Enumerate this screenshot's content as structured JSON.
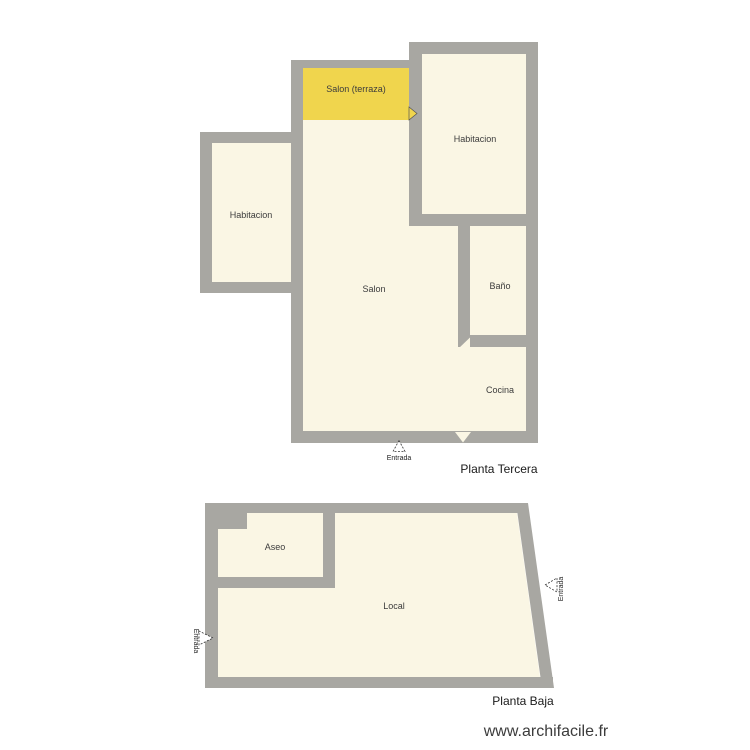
{
  "colors": {
    "wall": "#a8a7a2",
    "room_fill": "#faf6e4",
    "terrace_fill": "#f0d54d",
    "room_label_text": "#3c3c3c",
    "title_text": "#1a1a1a"
  },
  "plans": {
    "planta_tercera": {
      "title": "Planta Tercera",
      "rooms": {
        "salon_terraza": "Salon (terraza)",
        "habitacion_right": "Habitacion",
        "habitacion_left": "Habitacion",
        "salon": "Salon",
        "bano": "Baño",
        "cocina": "Cocina"
      },
      "entrance_label": "Entrada"
    },
    "planta_baja": {
      "title": "Planta Baja",
      "rooms": {
        "aseo": "Aseo",
        "local": "Local"
      },
      "entrance_left_label": "Entrada",
      "entrance_right_label": "Entrada"
    }
  },
  "watermark": {
    "url_text": "www.archifacile.fr"
  }
}
